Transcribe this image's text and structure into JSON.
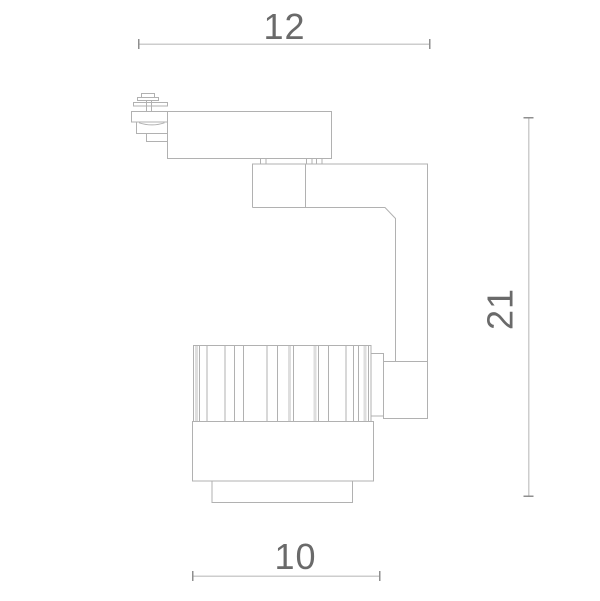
{
  "drawing": {
    "kind": "technical-dimension-drawing",
    "subject": "track-spotlight-side-view"
  },
  "dimensions": {
    "top_width": {
      "value": "12"
    },
    "right_height": {
      "value": "21"
    },
    "bottom_width": {
      "value": "10"
    }
  },
  "colors": {
    "background": "#ffffff",
    "outline": "#b1b1b1",
    "rib_band": "#dedede",
    "dimension_line": "#cdcdcd",
    "dimension_tick": "#8f8f8f",
    "dimension_text": "#6a6a6a"
  }
}
